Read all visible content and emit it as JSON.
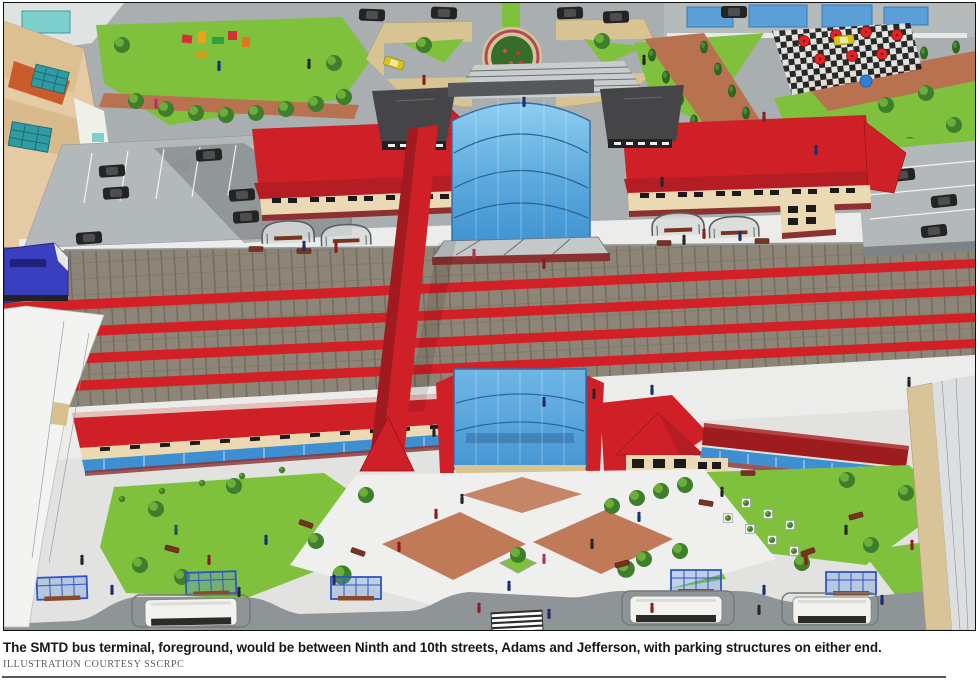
{
  "caption": {
    "text": "The SMTD bus terminal, foreground, would be between Ninth and 10th streets, Adams and Jefferson, with parking structures on either end.",
    "credit": "ILLUSTRATION COURTESY SSCRPC"
  },
  "illustration": {
    "colors": {
      "roof_red": "#cf2027",
      "roof_dark_red": "#9e1b1e",
      "roof_facet": "#b51d24",
      "pavilion_gray": "#454547",
      "glass_frame": "#2f6ea8",
      "rail_red": "#d31f26",
      "platform": "#ecedeb",
      "sidewalk": "#e2e3e0",
      "plaza_white": "#eff0ee",
      "street": "#8f9496",
      "parking": "#b3b8ba",
      "lawn": "#7fc13d",
      "brick_path": "#b9724f",
      "plaza_tan": "#d8c393",
      "terracotta": "#c07a58",
      "cream_wall": "#ead9b2",
      "beige_building": "#e5cba3",
      "awning_blue": "#3e8ed2",
      "trellis_blue": "#2f55c4",
      "train_blue": "#3a3fc0",
      "brick_base": "#8c3030",
      "barrier_gray": "#7d8284",
      "structure_white": "#f3f3f1",
      "structure_gray": "#dcdfdf"
    }
  }
}
